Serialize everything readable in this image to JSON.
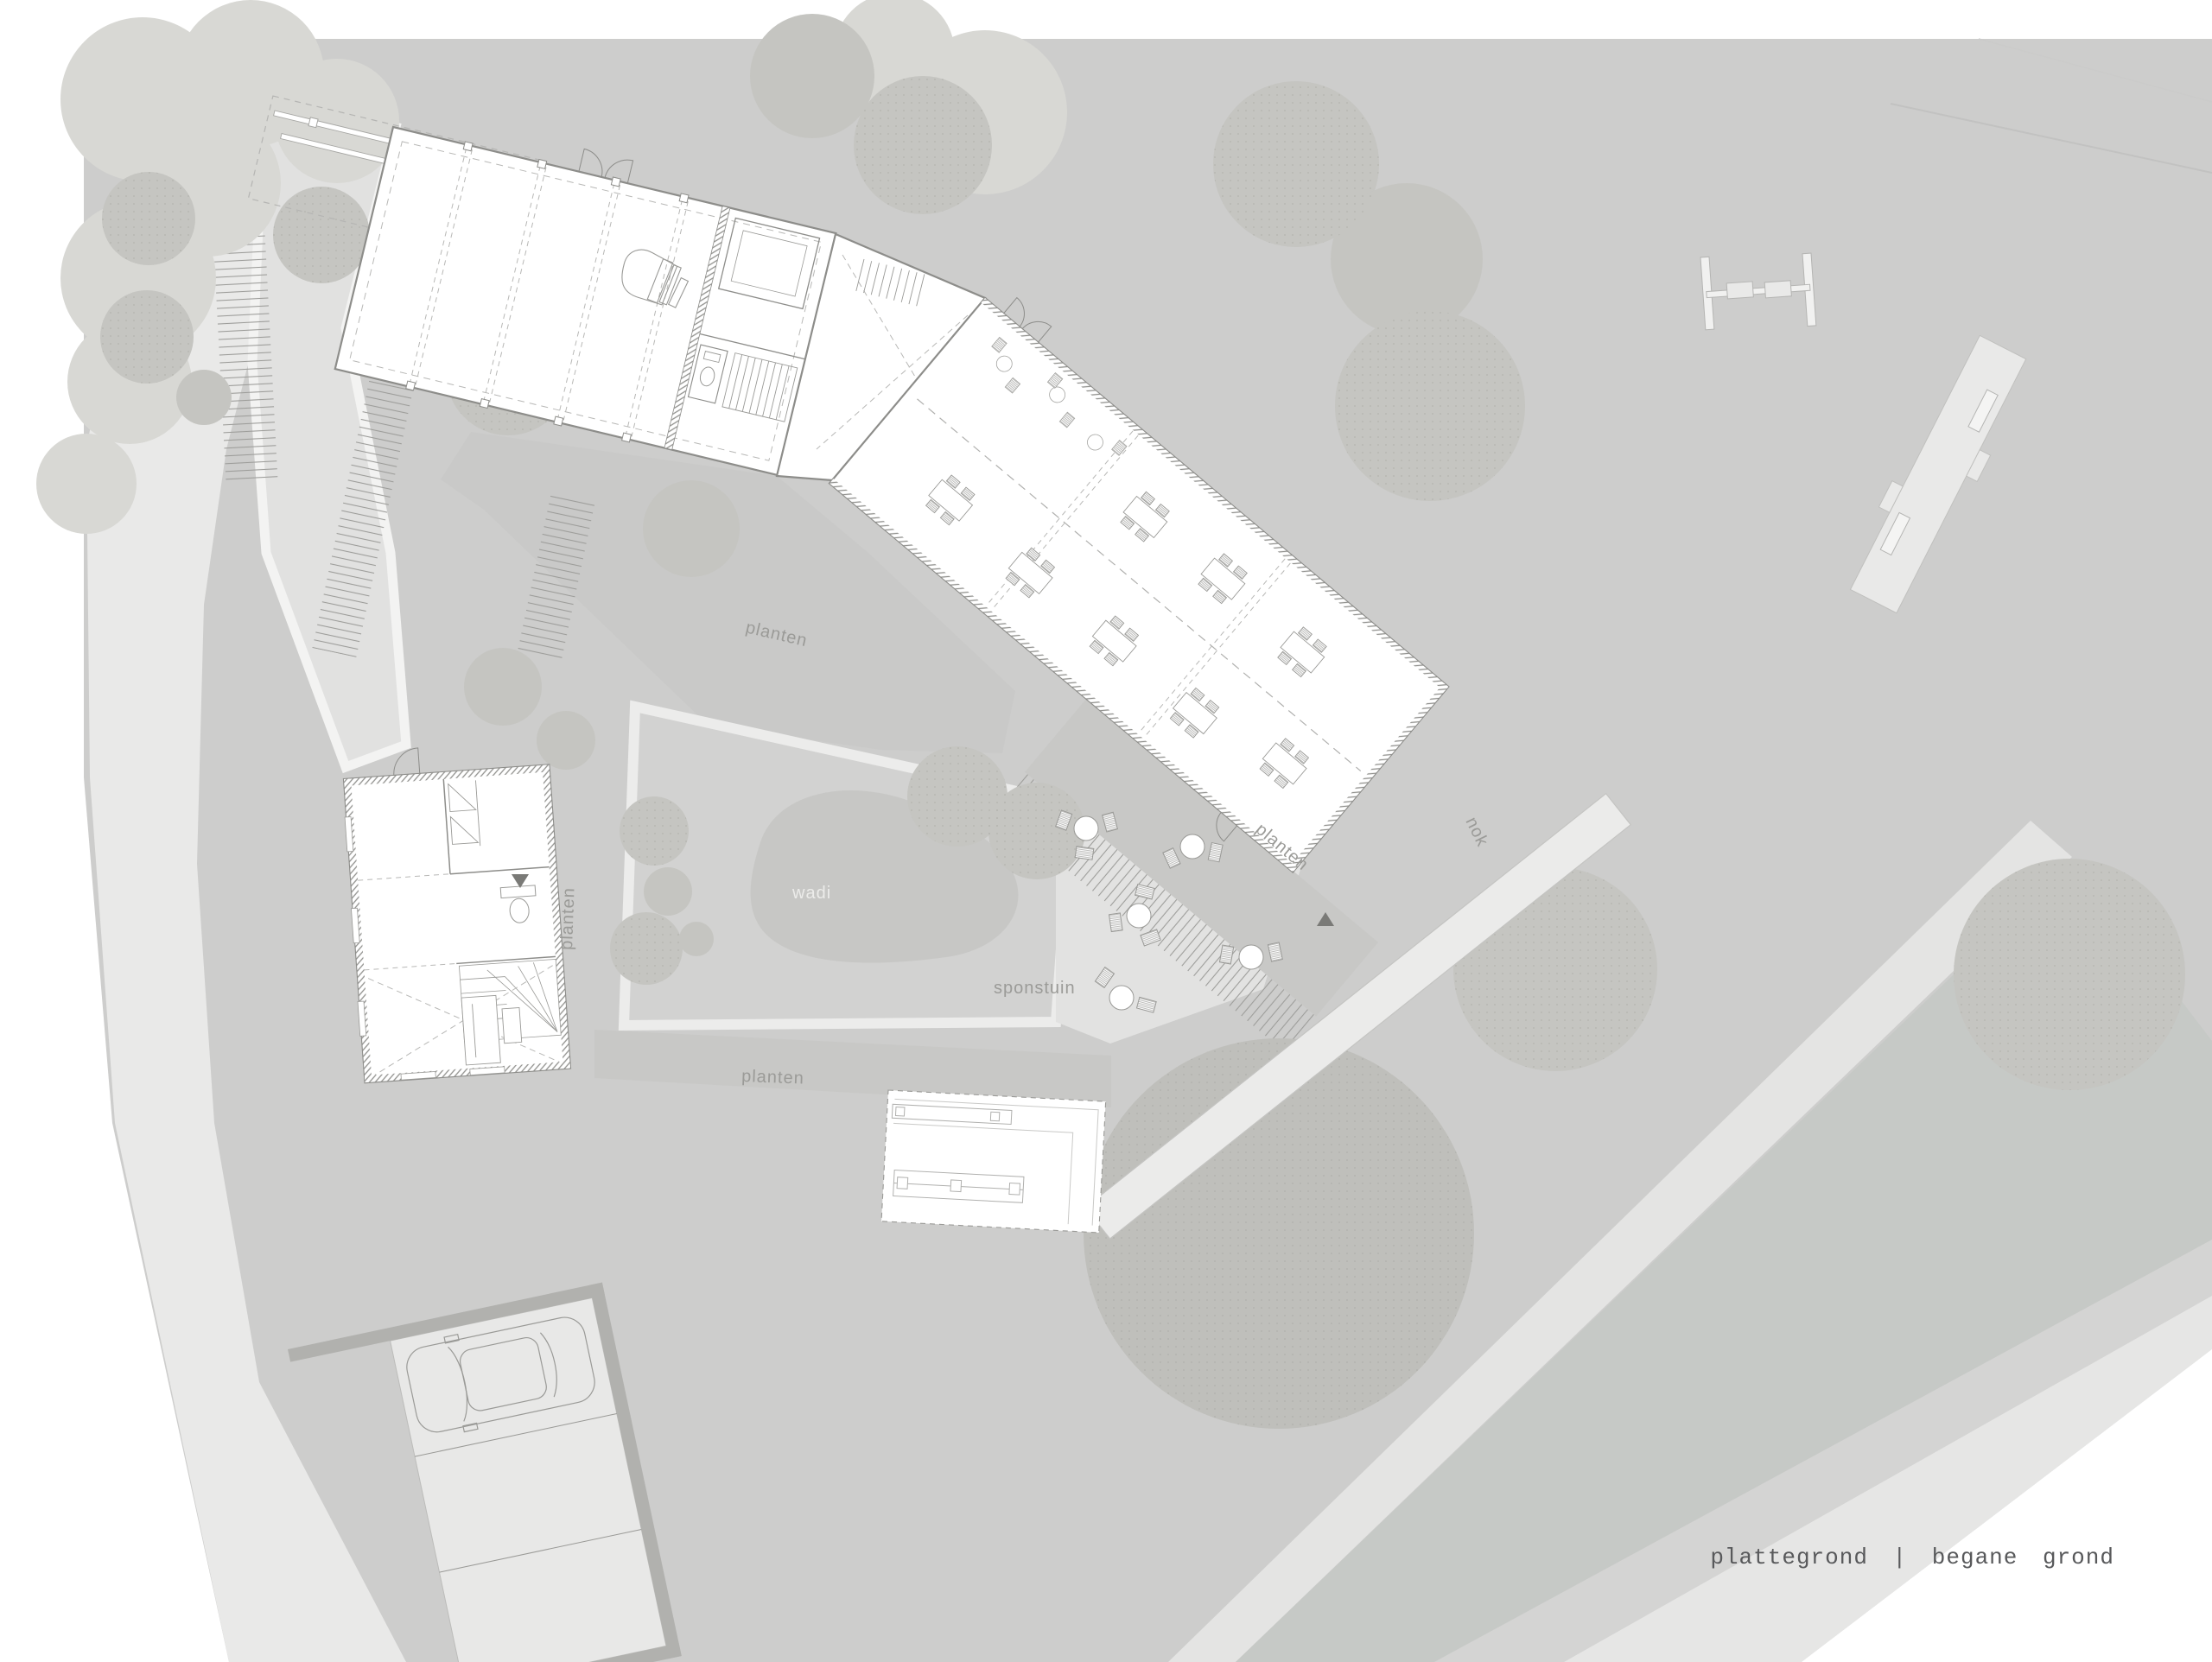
{
  "document": {
    "kind": "architectural-site-plan",
    "caption": "plattegrond  |  begane grond"
  },
  "labels": {
    "planten_under_hall": "planten",
    "planten_beside_house": "planten",
    "planten_south_strip": "planten",
    "planten_wing_strip": "planten",
    "wadi": "wadi",
    "sponstuin": "sponstuin",
    "nok": "nok"
  },
  "colors": {
    "page": "#ffffff",
    "site_base": "#cdcdcc",
    "road_light": "#e9e9e8",
    "path_band": "#e4e4e3",
    "courtyard": "#e1e1e0",
    "terrace": "#e2e2e1",
    "sponstuin": "#d2d2d1",
    "wadi": "#c7c7c5",
    "planten_strip": "#c8c8c6",
    "tree_dark": "#c5c5c1",
    "tree_big": "#bfbfbb",
    "tree_pale": "#d8d8d4",
    "river": "#c6c9c6",
    "far_bank": "#d4d4d3",
    "far_path": "#e6e6e5",
    "parking_border": "#b1b1ae",
    "building_fill": "#ffffff",
    "building_line": "#8d8d8a",
    "dashed_line": "#b8b8b6",
    "label_text": "#9b9b98",
    "caption_text": "#58595b"
  }
}
